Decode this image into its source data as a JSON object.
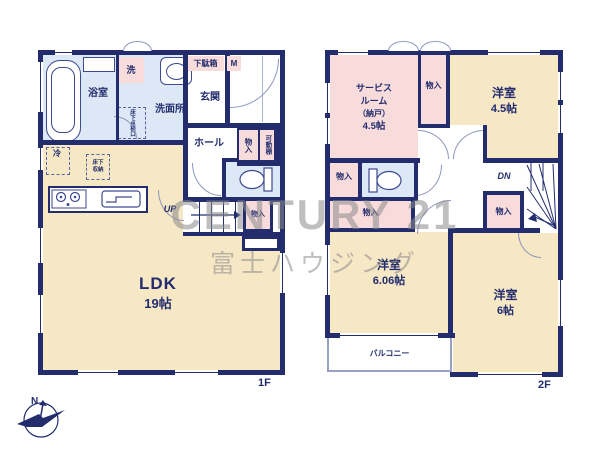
{
  "colors": {
    "wall": "#232d6e",
    "tatami": "#f6e7c5",
    "pink": "#f8dcdc",
    "blue": "#dce8f5",
    "line": "#8d96bd",
    "balcony": "#98a1c4",
    "watermark": "#8c8c8c"
  },
  "watermark": {
    "line1": "CENTURY 21",
    "line2": "富士ハウジング"
  },
  "compass": {
    "north": "N"
  },
  "labels": {
    "closet": "物入",
    "up": "UP",
    "down": "DN"
  },
  "f1": {
    "tag": "1F",
    "bathroom": "浴室",
    "laundry": "洗",
    "washroom": "洗面所",
    "hatch_col1": "床下",
    "hatch_col2": "点検口",
    "shoe_cabinet": "下駄箱",
    "meter": "M",
    "entrance": "玄関",
    "hall": "ホール",
    "movable_shelf": "可動棚",
    "fridge": "冷",
    "floor_storage1": "床下",
    "floor_storage2": "収納",
    "ldk": "LDK",
    "ldk_size": "19帖"
  },
  "f2": {
    "tag": "2F",
    "service1": "サービス",
    "service2": "ルーム",
    "service3": "（納戸）",
    "service4": "4.5帖",
    "bedroom_a": "洋室",
    "bedroom_a_size": "4.5帖",
    "bedroom_b": "洋室",
    "bedroom_b_size": "6.06帖",
    "bedroom_c": "洋室",
    "bedroom_c_size": "6帖",
    "balcony": "バルコニー"
  }
}
